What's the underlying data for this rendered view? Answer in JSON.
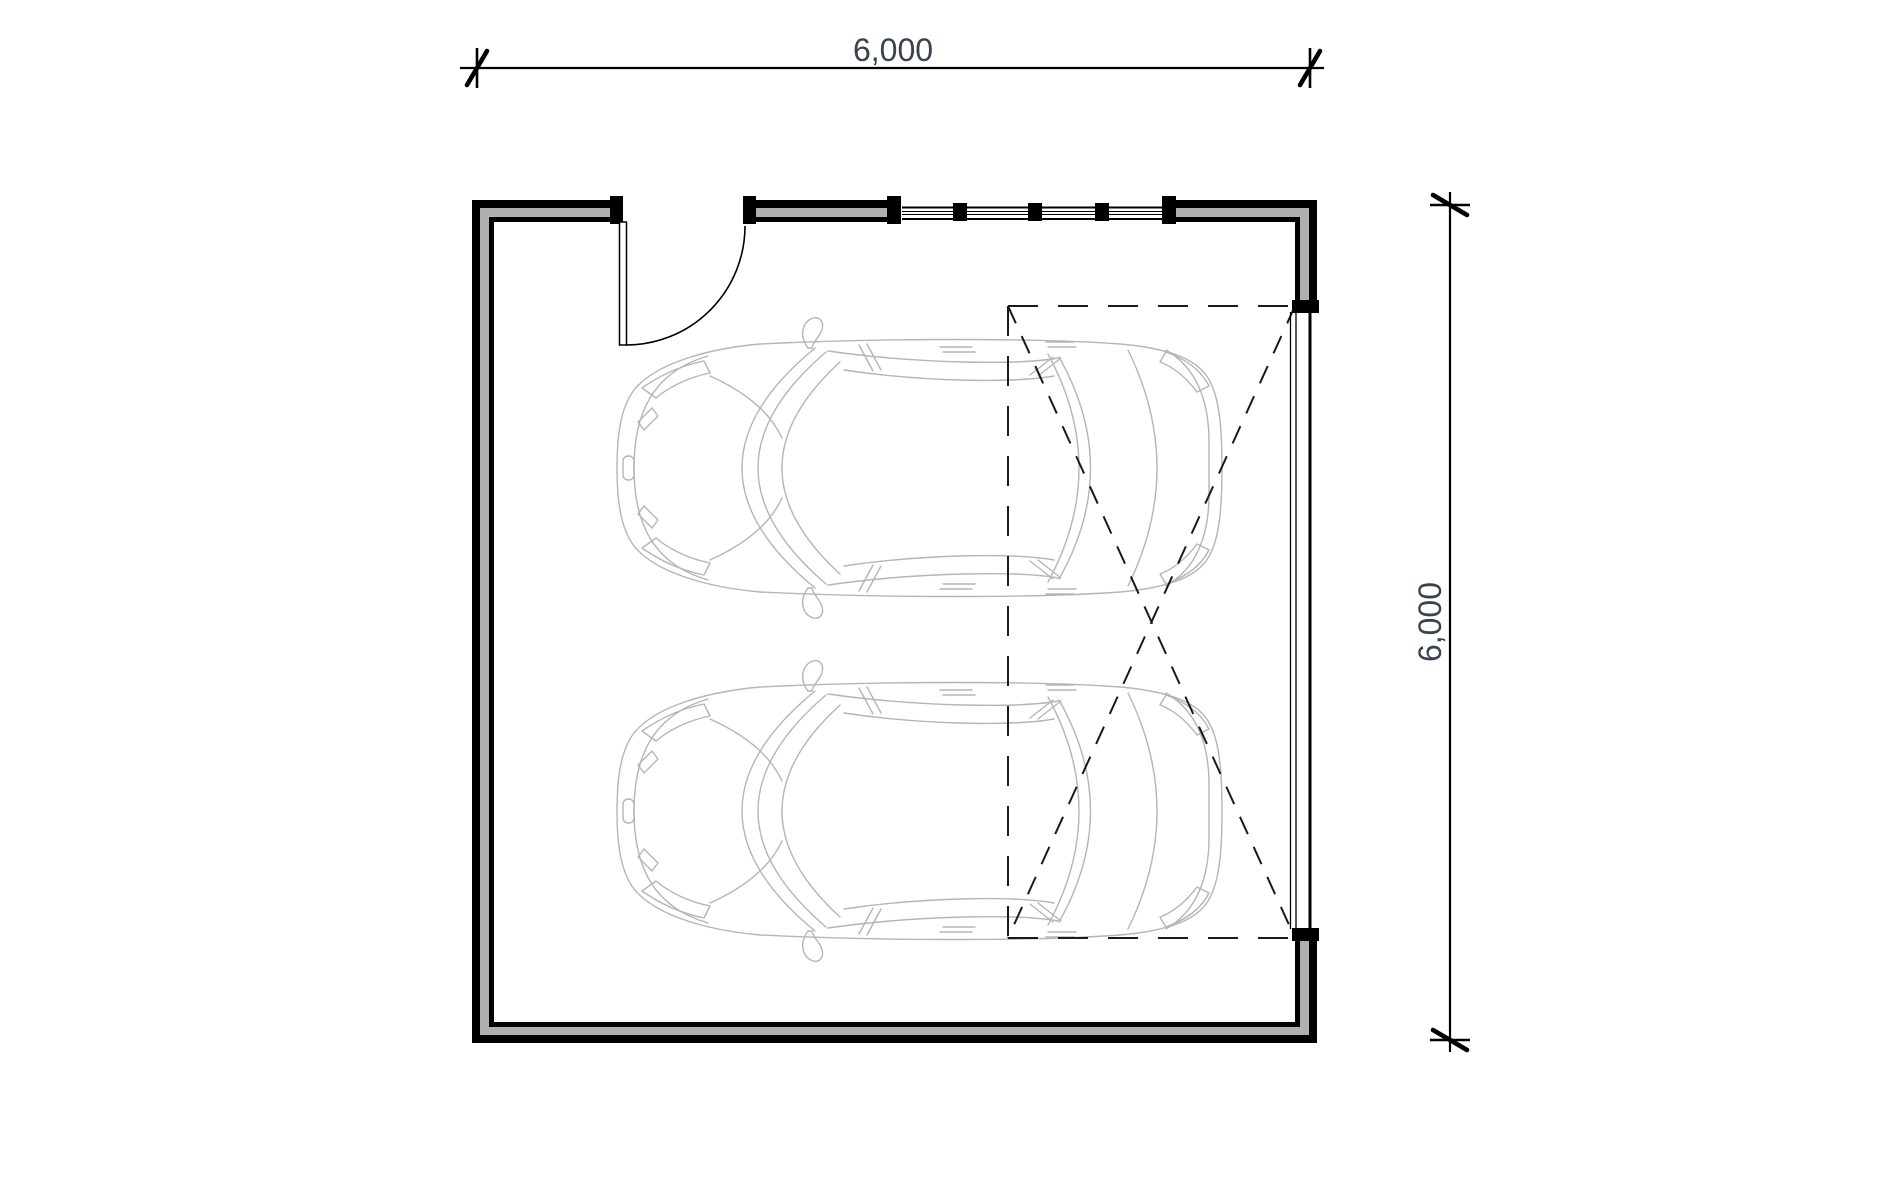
{
  "document": {
    "type": "architectural floor plan",
    "subject": "double garage with two cars, entry door, window and garage door swing",
    "background": "#ffffff"
  },
  "dimensions": {
    "horizontal": {
      "label": "6,000"
    },
    "vertical": {
      "label": "6,000"
    }
  },
  "plan": {
    "wall_outer_color": "#000000",
    "wall_core_color": "#b0b0b0",
    "line_color": "#000000",
    "dash_color": "#1a1a1a",
    "car_line_color": "#b5b5b5",
    "dim_text_color": "#39424e",
    "window": {
      "mullion_count": 3,
      "pane_count": 4
    },
    "cars": [
      {
        "name": "car-top-view",
        "facing": "left"
      },
      {
        "name": "car-top-view",
        "facing": "left"
      }
    ]
  }
}
